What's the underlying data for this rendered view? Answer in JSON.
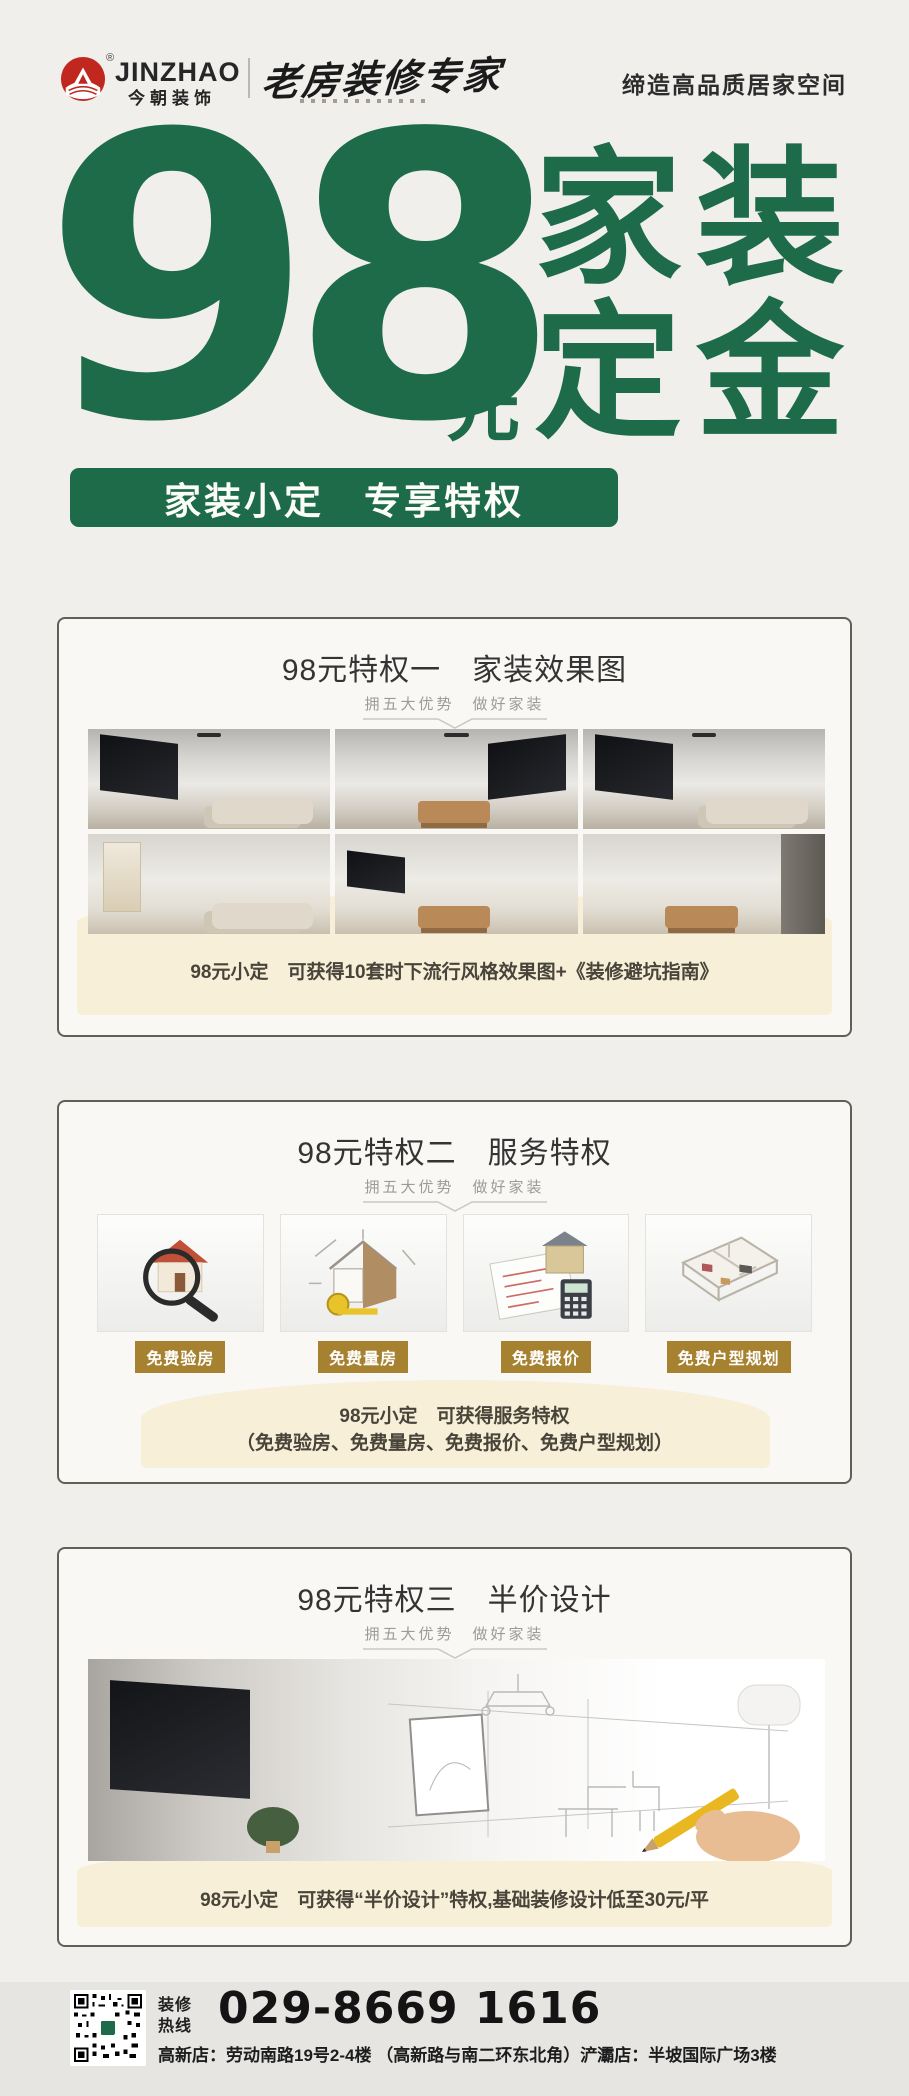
{
  "colors": {
    "green": "#1d6b49",
    "cream": "#f7efd8",
    "gold": "#a6812f",
    "logo_red": "#c0271e",
    "page_bg": "#f0efec",
    "footer_bg": "#e6e5e2"
  },
  "header": {
    "registered": "®",
    "brand_en": "JINZHAO",
    "brand_cn": "今朝装饰",
    "expert_badge": "老房装修专家",
    "slogan": "缔造高品质居家空间"
  },
  "hero": {
    "number": "98",
    "unit": "元",
    "line1": "家装",
    "line2": "定金",
    "banner": "家装小定　专享特权"
  },
  "cards": [
    {
      "title": "98元特权一　家装效果图",
      "subtitle": "拥五大优势　做好家装",
      "caption": "98元小定　可获得10套时下流行风格效果图+《装修避坑指南》"
    },
    {
      "title": "98元特权二　服务特权",
      "subtitle": "拥五大优势　做好家装",
      "services": [
        {
          "label": "免费验房"
        },
        {
          "label": "免费量房"
        },
        {
          "label": "免费报价"
        },
        {
          "label": "免费户型规划"
        }
      ],
      "caption_line1": "98元小定　可获得服务特权",
      "caption_line2": "（免费验房、免费量房、免费报价、免费户型规划）"
    },
    {
      "title": "98元特权三　半价设计",
      "subtitle": "拥五大优势　做好家装",
      "caption": "98元小定　可获得“半价设计”特权,基础装修设计低至30元/平"
    }
  ],
  "footer": {
    "hotline_top": "装修",
    "hotline_bottom": "热线",
    "phone": "029-8669 1616",
    "address": "高新店：劳动南路19号2-4楼 （高新路与南二环东北角）浐灞店：半坡国际广场3楼"
  }
}
